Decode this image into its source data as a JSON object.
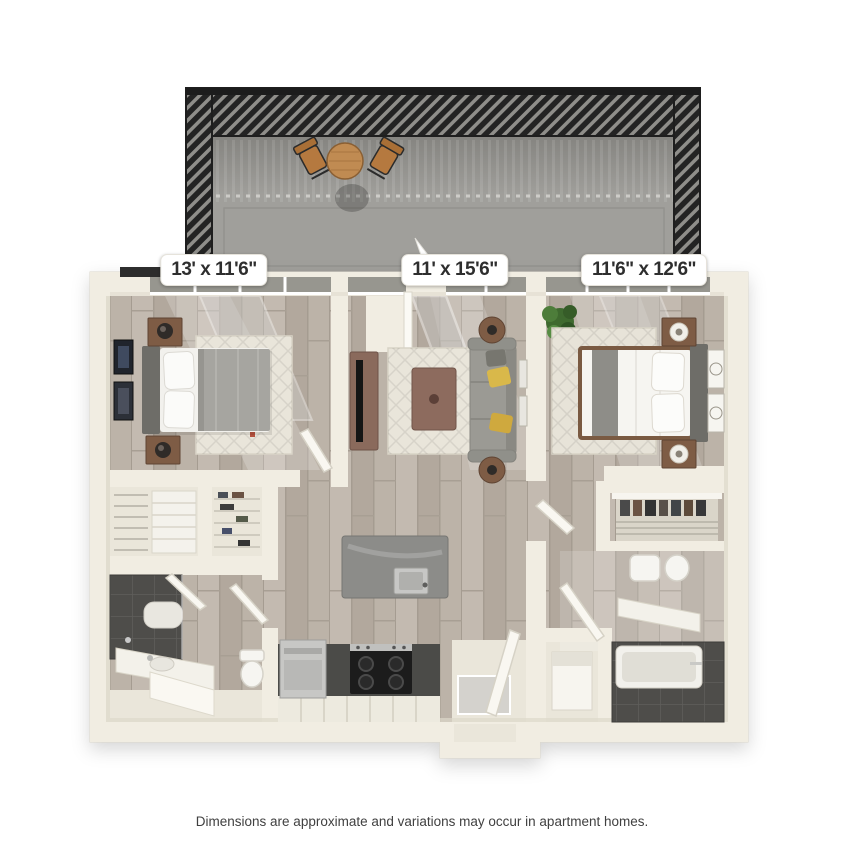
{
  "labels": {
    "bedroom_left_dimensions": "13' x 11'6\"",
    "living_room_dimensions": "11' x 15'6\"",
    "bedroom_right_dimensions": "11'6\" x 12'6\""
  },
  "disclaimer": "Dimensions are approximate and variations may occur in apartment homes.",
  "colors": {
    "background": "#ffffff",
    "wall_cream": "#f1ede2",
    "wall_shade": "#ddd8ca",
    "wood_floor": "#b9b0a5",
    "tile_light": "#eae6da",
    "balcony_floor": "#a09f9b",
    "railing_dark": "#232323",
    "railing_slat": "#8f8e8a",
    "window_glass": "#97968f",
    "dark_tile": "#4e4d4a",
    "sofa_gray": "#9b9a94",
    "bed_gray": "#a6a5a0",
    "bed_white": "#f6f5f1",
    "headboard_gray": "#6e6d68",
    "wood_furniture": "#7e5c45",
    "table_wood": "#c08b52",
    "chair_wood": "#b5793f",
    "island_gray": "#8c8c89",
    "cabinet_dark": "#4b4b48",
    "appliance_silver": "#c7c7c5",
    "accent_yellow": "#d9b84a",
    "plant_green": "#4d7d3a",
    "rug_cream": "#e9e5da",
    "label_bg": "#ffffff",
    "label_text": "#2e2e2e",
    "disclaimer_text": "#404040"
  }
}
